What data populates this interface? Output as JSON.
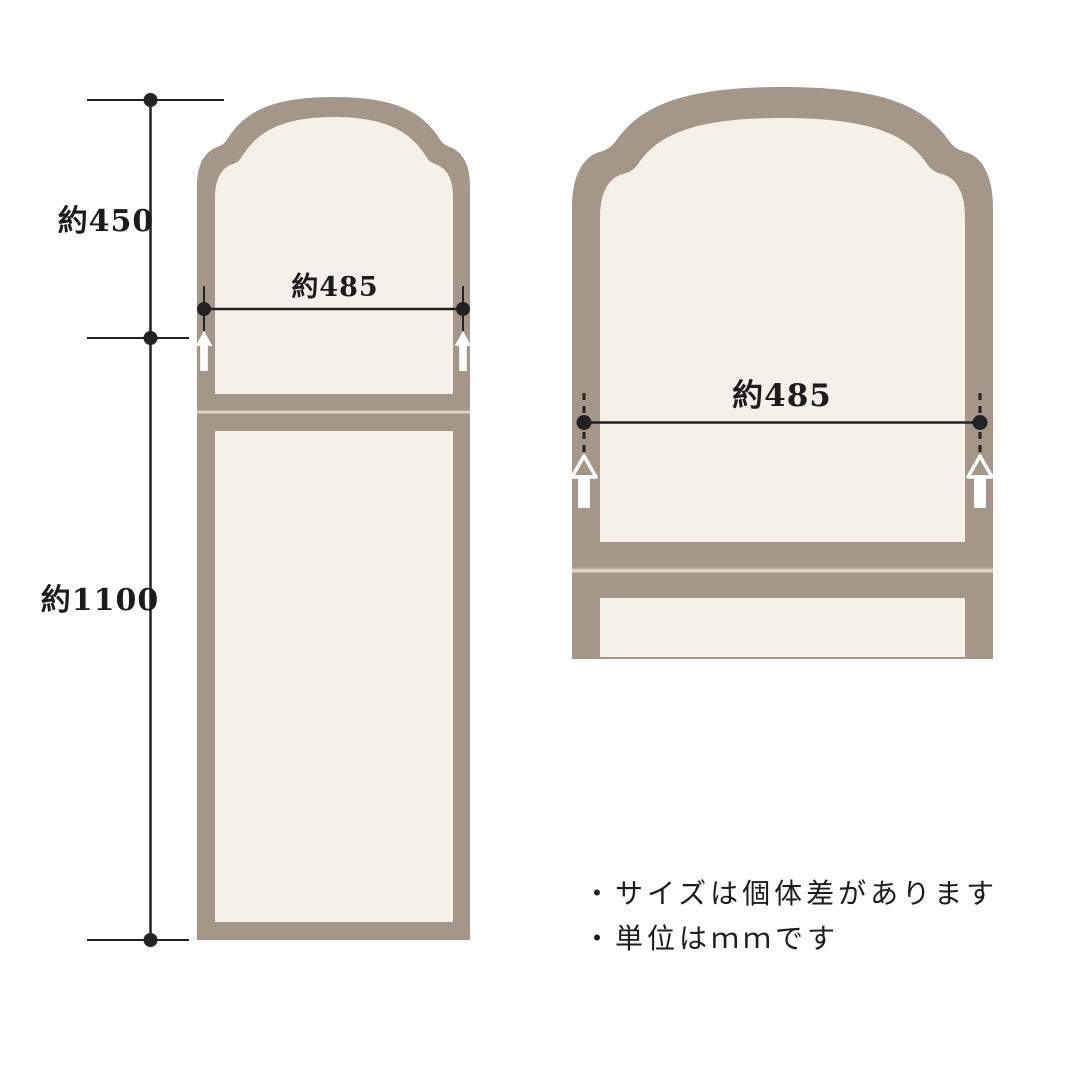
{
  "colors": {
    "background": "#ffffff",
    "frame": "#a4978a",
    "panel": "#f5f1e8",
    "seam_light": "#dcd3c6",
    "seam_dark": "#b3a799",
    "line": "#222222",
    "text": "#1c1c1c",
    "arrow": "#ffffff"
  },
  "left_figure": {
    "dim_height_top": "約450",
    "dim_height_bottom": "約1100",
    "dim_width": "約485"
  },
  "right_figure": {
    "dim_width": "約485"
  },
  "notes": {
    "line1": "・サイズは個体差があります",
    "line2": "・単位はｍｍです"
  }
}
